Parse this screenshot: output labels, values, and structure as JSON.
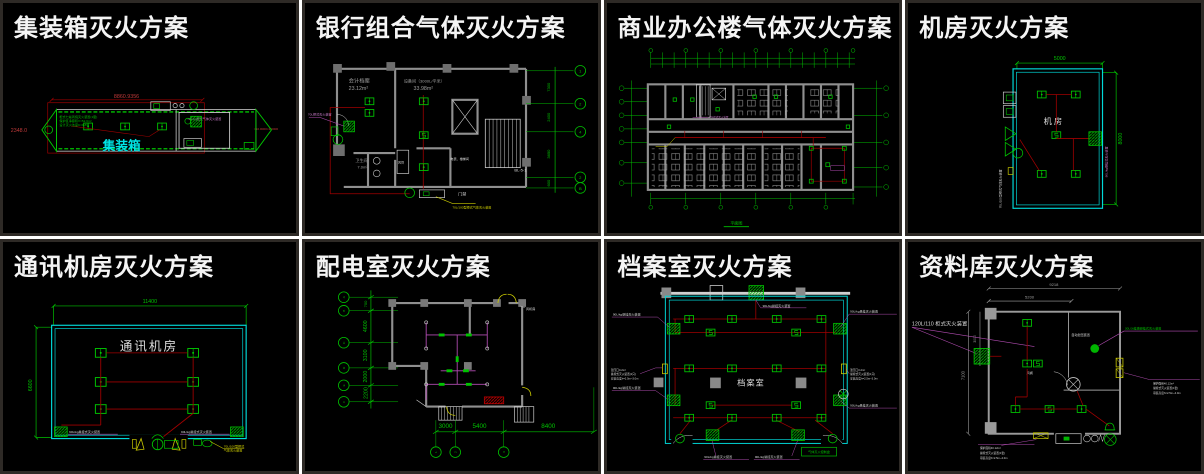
{
  "app": {
    "background": "#ffffff",
    "panel_background": "#000000",
    "panel_border": "#2e2a26"
  },
  "colors": {
    "cad_green": "#00c300",
    "cad_red": "#a00000",
    "cad_cyan": "#00d9d9",
    "cad_magenta": "#b24cb2",
    "cad_yellow": "#cdcd00",
    "cad_white": "#e8e8e8",
    "wall_gray": "#8f8f8f"
  },
  "panels": [
    {
      "id": "container",
      "title": "集装箱灭火方案",
      "room_label": "集装箱",
      "dim_top": "8860.9356",
      "dim_left": "2348.0",
      "dim_right": "≈10.0000×1.0000",
      "device_label": "70L/kg柜式气体灭火装置",
      "note_lines": [
        "柜式七氟丙烷灭火装置(1套)",
        "保护区净容积V=52.6m³",
        "设计灭火浓度C=9.8%"
      ]
    },
    {
      "id": "bank",
      "title": "银行组合气体灭火方案",
      "room1_name": "会计档案",
      "room1_area": "23.12m²",
      "room2_name": "设备间（3000L/平米）",
      "room2_area": "33.98m²",
      "room3_name": "卫生间",
      "room3_area": "7.0m²",
      "duct_label": "风管",
      "meter_label": "电表、楼梯间",
      "door_label": "门禁",
      "ref_label": "BL-5-1",
      "axis_dims": [
        "7300",
        "2400",
        "3650",
        "600"
      ],
      "axis_bubbles": [
        "1",
        "2",
        "4",
        "2",
        "B"
      ],
      "device_label_left": "70L柜式灭火装置",
      "device_label_bottom": "70L/100型柜式气体灭火装置"
    },
    {
      "id": "office",
      "title": "商业办公楼气体灭火方案",
      "caption": "平面图",
      "device_label": "70L柜式灭火装置"
    },
    {
      "id": "machine-room",
      "title": "机房灭火方案",
      "room_label": "机房",
      "dim_top": "5000",
      "dim_right": "8000",
      "device_label_right": "90L/kg悬挂式灭火装置",
      "device_label_left": "70L/100型柜式气体灭火装置"
    },
    {
      "id": "comm-room",
      "title": "通讯机房灭火方案",
      "room_label": "通讯机房",
      "dim_top": "11400",
      "dim_left": "6600",
      "device_label_left": "90L/kg悬挂式灭火装置",
      "device_label_right": "90L/kg悬挂式灭火装置",
      "door_note_line1": "70L/100型柜式",
      "door_note_line2": "气体灭火装置"
    },
    {
      "id": "power-room",
      "title": "配电室灭火方案",
      "fan_room_label": "风机房",
      "left_dims": [
        "700",
        "4600",
        "3100",
        "2000",
        "2200"
      ],
      "bottom_dims": [
        "3000",
        "5400",
        "8400"
      ],
      "left_bubbles": [
        "A",
        "B",
        "C",
        "D",
        "E",
        "F"
      ],
      "bottom_bubbles": [
        "1",
        "2",
        "3"
      ]
    },
    {
      "id": "archive",
      "title": "档案室灭火方案",
      "room_label": "档案室",
      "label_top": "90L/kg悬挂灭火装置",
      "label_left_top": "90L/kg悬挂灭火装置",
      "label_left_mid_lines": [
        "泄压口0.2m²",
        "悬挂式灭火装置(1只)",
        "安装高度h=2.5m~3.0m"
      ],
      "label_left_bottom": "90L/kg悬挂灭火装置",
      "label_right_top": "90L/kg悬挂灭火装置",
      "label_right_mid_lines": [
        "泄压口0.2m²",
        "悬挂式灭火装置(1只)",
        "安装高度h=2.5m~3.0m"
      ],
      "label_right_bottom": "90L/kg悬挂灭火装置",
      "label_bottom_left": "90L/kg悬挂灭火装置",
      "label_bottom_right": "90L/kg悬挂灭火装置",
      "control_label": "气体灭火控制盘"
    },
    {
      "id": "data-room",
      "title": "资料库灭火方案",
      "cabinet_label": "120L/110 柜式灭火装置",
      "hanging_label": "30L/3t挂墙悬挂式灭火装置",
      "vent_label": "自动泄压装置",
      "damper_label": "风阀",
      "dim_top_outer": "9218",
      "dim_top_inner": "5200",
      "dim_left_outer": "7100",
      "dim_left_inner": "3000",
      "note_right_lines": [
        "保护面积40.12m²",
        "悬挂式灭火装置(1套)",
        "吊装高度h=2.5m~4.0m"
      ],
      "note_bottom_lines": [
        "保护面积40.12m²",
        "悬挂式灭火装置(1套)",
        "吊装高度h=2.5m~4.0m"
      ]
    }
  ]
}
